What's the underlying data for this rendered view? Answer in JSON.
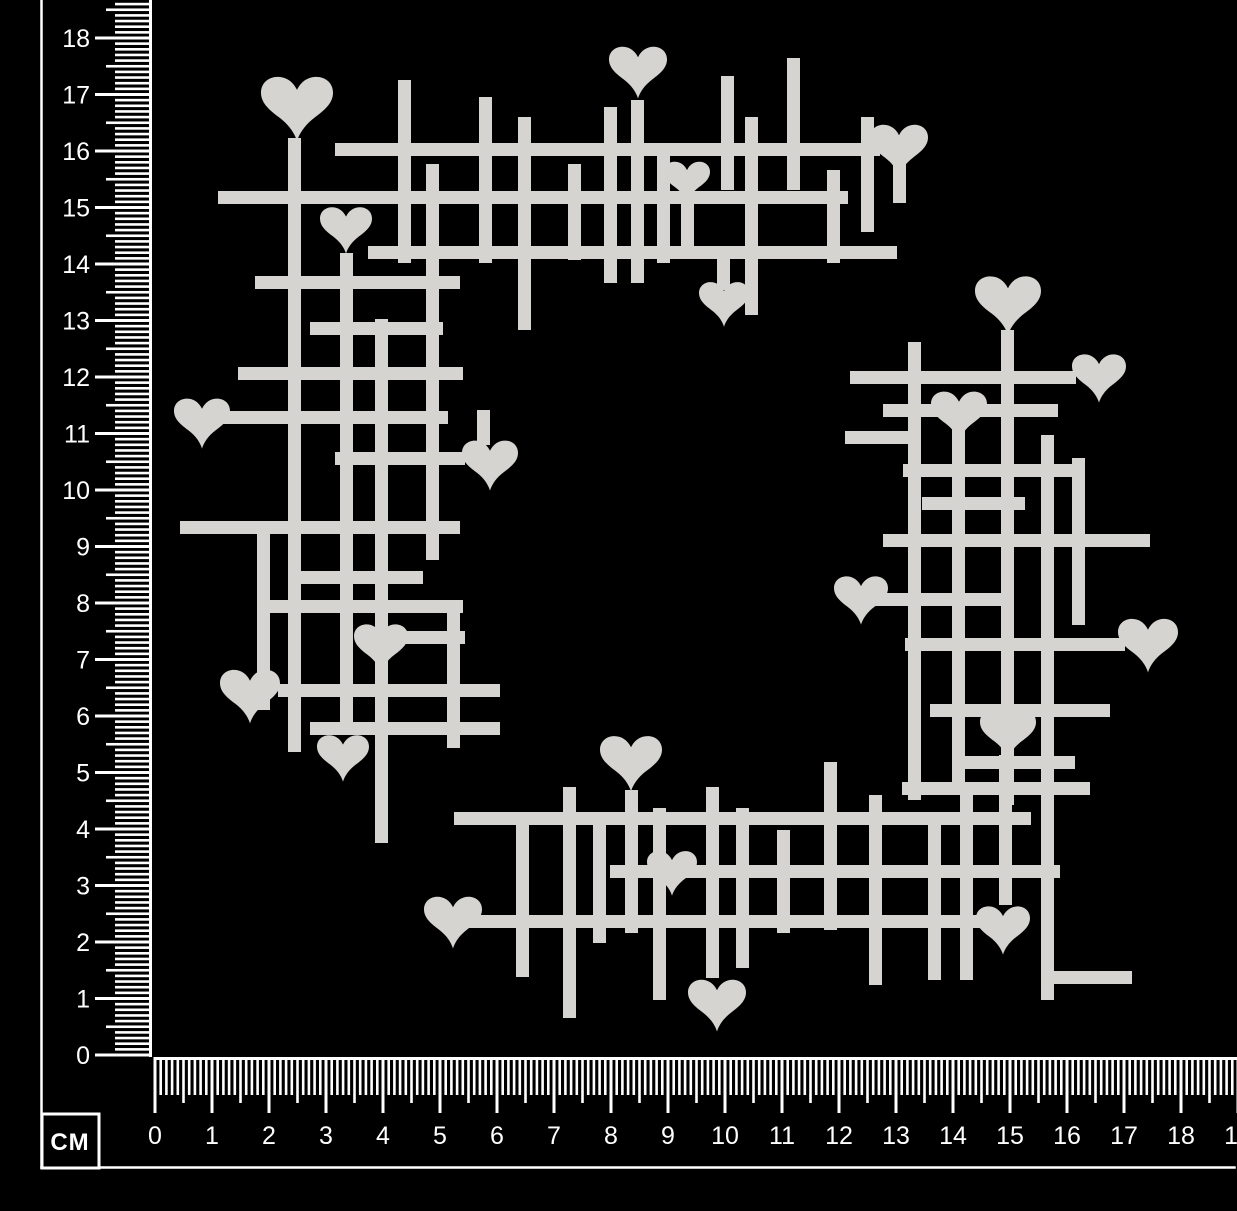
{
  "scene": {
    "width": 1237,
    "height": 1211,
    "background_color": "#000000",
    "description": "White chipboard heart-grid wreath craft piece photographed on black with centimetre rulers"
  },
  "ruler": {
    "unit_label": "CM",
    "color": "#ffffff",
    "vertical": {
      "labels": [
        "0",
        "1",
        "2",
        "3",
        "4",
        "5",
        "6",
        "7",
        "8",
        "9",
        "10",
        "11",
        "12",
        "13",
        "14",
        "15",
        "16",
        "17",
        "18"
      ],
      "origin_y": 1055,
      "px_per_cm": 56.5,
      "baseline_x": 152,
      "label_right_x": 90,
      "major_tick_start_x": 95,
      "medium_tick_start_x": 106,
      "minor_tick_start_x": 115,
      "tick_thickness": 2.6
    },
    "horizontal": {
      "labels": [
        "0",
        "1",
        "2",
        "3",
        "4",
        "5",
        "6",
        "7",
        "8",
        "9",
        "10",
        "11",
        "12",
        "13",
        "14",
        "15",
        "16",
        "17",
        "18",
        "19"
      ],
      "origin_x": 155,
      "px_per_cm": 57,
      "baseline_y": 1057,
      "label_baseline_y": 1144,
      "major_tick_end_y": 1113,
      "medium_tick_end_y": 1103,
      "minor_tick_end_y": 1095,
      "tick_thickness": 2.6
    },
    "frame": {
      "left_line_x": 41.5,
      "bottom_line_y": 1167.5,
      "line_thickness": 2.5,
      "unit_box": {
        "x": 42,
        "y": 1114,
        "width": 57,
        "height": 54,
        "border": 3
      }
    }
  },
  "artwork": {
    "name": "heart-grid-chipboard-wreath",
    "color": "#d5d4d0",
    "bar_thickness": 13,
    "bars": [
      [
        335,
        143,
        545,
        13
      ],
      [
        218,
        191,
        630,
        13
      ],
      [
        368,
        246,
        529,
        13
      ],
      [
        398,
        80,
        13,
        183
      ],
      [
        426,
        164,
        13,
        396
      ],
      [
        479,
        97,
        13,
        166
      ],
      [
        518,
        117,
        13,
        213
      ],
      [
        568,
        164,
        13,
        96
      ],
      [
        604,
        107,
        13,
        176
      ],
      [
        631,
        100,
        13,
        183
      ],
      [
        657,
        155,
        13,
        108
      ],
      [
        681,
        204,
        13,
        46
      ],
      [
        721,
        76,
        13,
        114
      ],
      [
        745,
        117,
        13,
        198
      ],
      [
        787,
        58,
        13,
        132
      ],
      [
        827,
        170,
        13,
        93
      ],
      [
        861,
        117,
        13,
        115
      ],
      [
        893,
        163,
        13,
        40
      ],
      [
        717,
        252,
        13,
        38
      ],
      [
        288,
        138,
        13,
        614
      ],
      [
        340,
        253,
        13,
        482
      ],
      [
        375,
        319,
        13,
        524
      ],
      [
        477,
        410,
        13,
        35
      ],
      [
        257,
        530,
        13,
        180
      ],
      [
        447,
        600,
        13,
        148
      ],
      [
        255,
        276,
        205,
        13
      ],
      [
        310,
        322,
        133,
        13
      ],
      [
        238,
        367,
        225,
        13
      ],
      [
        222,
        411,
        226,
        13
      ],
      [
        335,
        452,
        130,
        13
      ],
      [
        180,
        521,
        280,
        13
      ],
      [
        293,
        571,
        130,
        13
      ],
      [
        258,
        600,
        205,
        13
      ],
      [
        358,
        631,
        107,
        13
      ],
      [
        278,
        684,
        222,
        13
      ],
      [
        310,
        722,
        190,
        13
      ],
      [
        1001,
        330,
        13,
        475
      ],
      [
        908,
        342,
        13,
        458
      ],
      [
        952,
        425,
        13,
        370
      ],
      [
        1041,
        435,
        13,
        565
      ],
      [
        1072,
        458,
        13,
        167
      ],
      [
        850,
        371,
        226,
        13
      ],
      [
        883,
        404,
        175,
        13
      ],
      [
        845,
        431,
        67,
        13
      ],
      [
        903,
        464,
        182,
        13
      ],
      [
        922,
        497,
        103,
        13
      ],
      [
        883,
        534,
        267,
        13
      ],
      [
        868,
        593,
        144,
        13
      ],
      [
        905,
        638,
        220,
        13
      ],
      [
        930,
        704,
        180,
        13
      ],
      [
        957,
        756,
        118,
        13
      ],
      [
        902,
        782,
        188,
        13
      ],
      [
        454,
        812,
        577,
        13
      ],
      [
        610,
        865,
        450,
        13
      ],
      [
        462,
        915,
        518,
        13
      ],
      [
        1047,
        971,
        85,
        13
      ],
      [
        516,
        818,
        13,
        159
      ],
      [
        563,
        787,
        13,
        231
      ],
      [
        593,
        818,
        13,
        125
      ],
      [
        625,
        790,
        13,
        143
      ],
      [
        653,
        808,
        13,
        192
      ],
      [
        706,
        787,
        13,
        191
      ],
      [
        736,
        808,
        13,
        160
      ],
      [
        777,
        830,
        13,
        103
      ],
      [
        824,
        762,
        13,
        168
      ],
      [
        869,
        795,
        13,
        190
      ],
      [
        928,
        818,
        13,
        162
      ],
      [
        960,
        795,
        13,
        185
      ],
      [
        999,
        755,
        13,
        150
      ]
    ],
    "hearts": [
      [
        297,
        107,
        72
      ],
      [
        638,
        71,
        58
      ],
      [
        899,
        149,
        58
      ],
      [
        687,
        181,
        46
      ],
      [
        346,
        229,
        52
      ],
      [
        724,
        303,
        50
      ],
      [
        202,
        422,
        56
      ],
      [
        490,
        464,
        56
      ],
      [
        381,
        647,
        54
      ],
      [
        250,
        695,
        60
      ],
      [
        343,
        757,
        52
      ],
      [
        1008,
        304,
        66
      ],
      [
        1099,
        377,
        54
      ],
      [
        959,
        415,
        56
      ],
      [
        861,
        599,
        54
      ],
      [
        1148,
        644,
        60
      ],
      [
        1008,
        733,
        56
      ],
      [
        631,
        762,
        62
      ],
      [
        672,
        872,
        50
      ],
      [
        453,
        921,
        58
      ],
      [
        1003,
        929,
        54
      ],
      [
        717,
        1004,
        58
      ]
    ]
  }
}
